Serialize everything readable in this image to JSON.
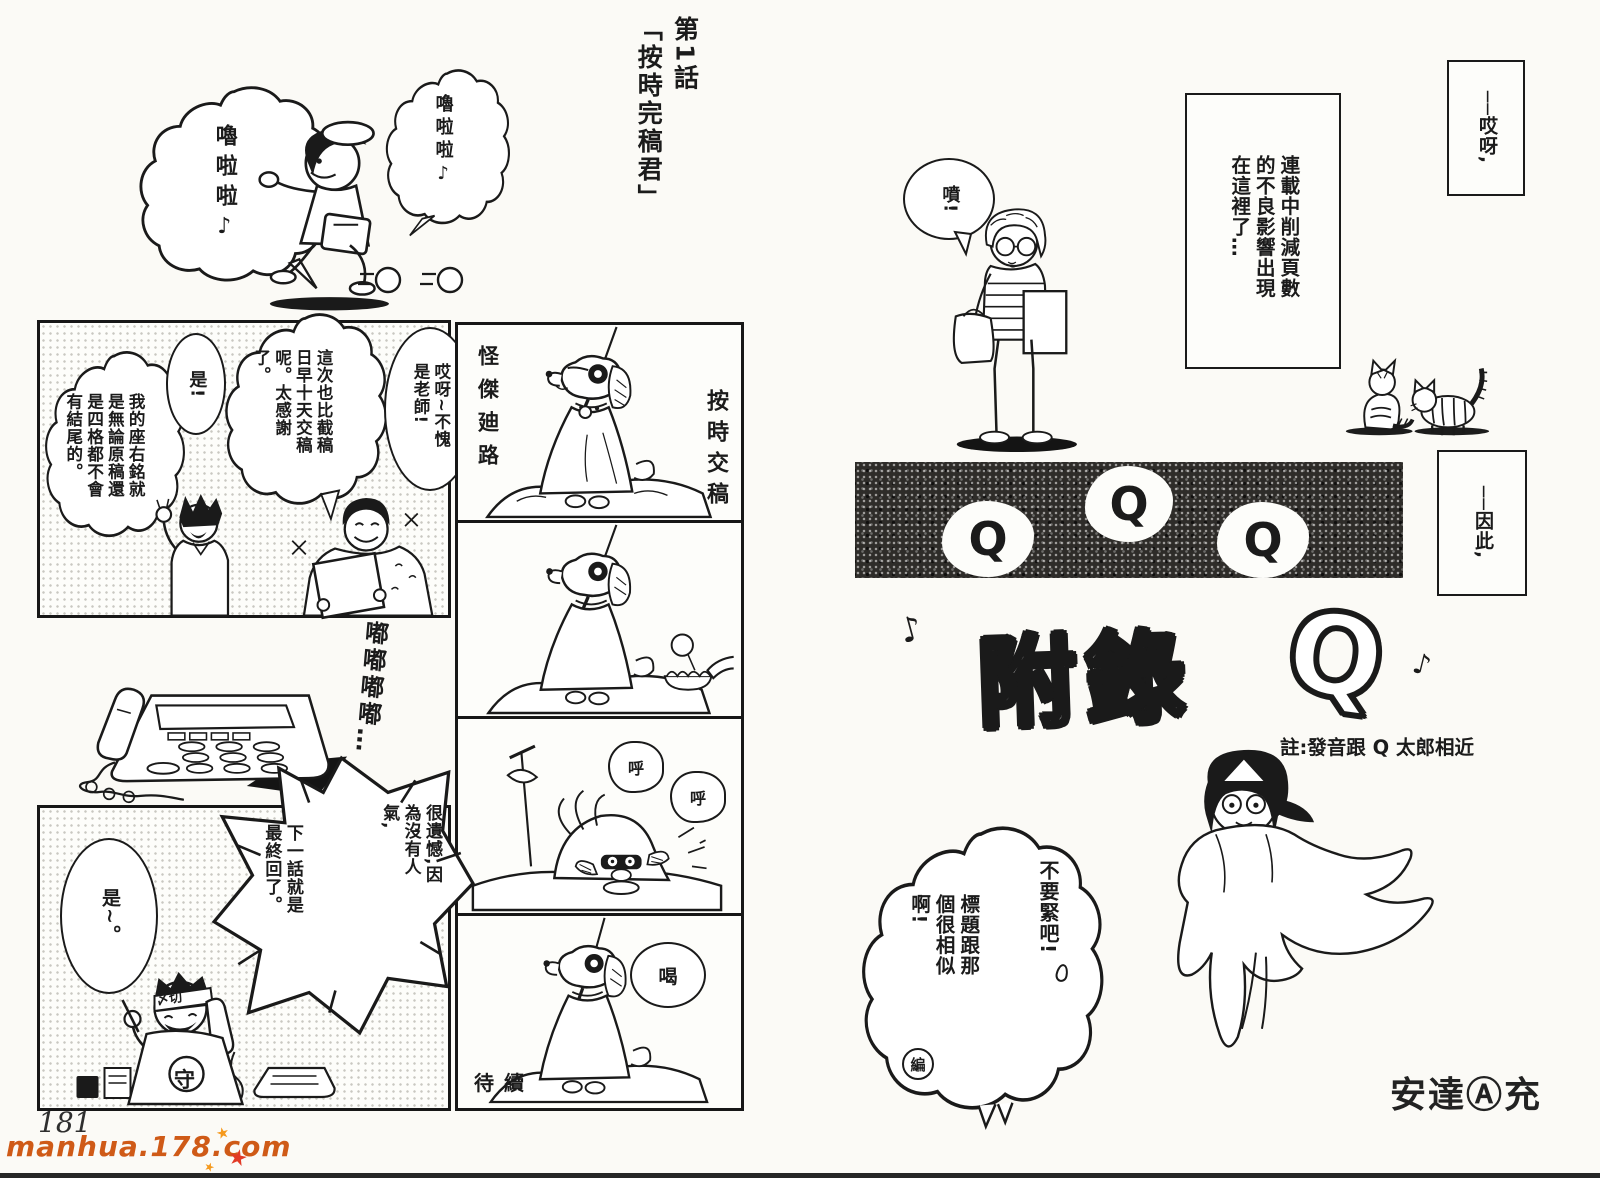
{
  "page": {
    "number": "181",
    "watermark": "manhua.178.com"
  },
  "colors": {
    "ink": "#1a1a1a",
    "paper": "#fbfaf6",
    "watermark_orange": "#cf5a17",
    "star_orange": "#f5991d",
    "star_red": "#e23a26"
  },
  "left_page": {
    "chapter_title": "第1話\n「按時完稿君」",
    "intro": {
      "hum_left": "嚕啦啦♪",
      "hum_right": "嚕啦啦♪"
    },
    "panel1": {
      "greeting": "哎呀~不愧是老師!",
      "thanks": "這次也比截稿日早十天交稿呢。太感謝了。",
      "yes": "是!",
      "motto": "我的座右銘就是無論原稿還是四格都不會有結尾的。"
    },
    "phone_sfx": "嘟嘟嘟嘟…",
    "panel2": {
      "yes": "是~。",
      "call_popularity": "很遺憾,因為沒有人氣,",
      "call_final": "下一話就是最終回了。",
      "headband": "〆切",
      "shirt_badge": "守"
    },
    "strip": {
      "hero_name": "怪傑廸路",
      "deadline_label": "按時交稿",
      "breath_sfx_1": "呼",
      "breath_sfx_2": "呼",
      "shout_sfx": "喝",
      "to_be_continued": "待續"
    }
  },
  "right_page": {
    "caption_sigh": "──哎呀,",
    "caption_box": "連載中削減頁數的不良影響出現在這裡了…",
    "tsk": "噴!",
    "caption_thus": "──因此,",
    "banner_letters": [
      "Q",
      "Q",
      "Q"
    ],
    "title": {
      "main": "附錄",
      "q": "Q",
      "note_left": "♪",
      "note_right": "♪",
      "caption": "註:發音跟 Q 太郎相近"
    },
    "cloud": {
      "no_worries": "不要緊吧!",
      "similar_title": "標題跟那個很相似啊!",
      "editor_mark": "編"
    },
    "author": "安達Ⓐ充"
  }
}
